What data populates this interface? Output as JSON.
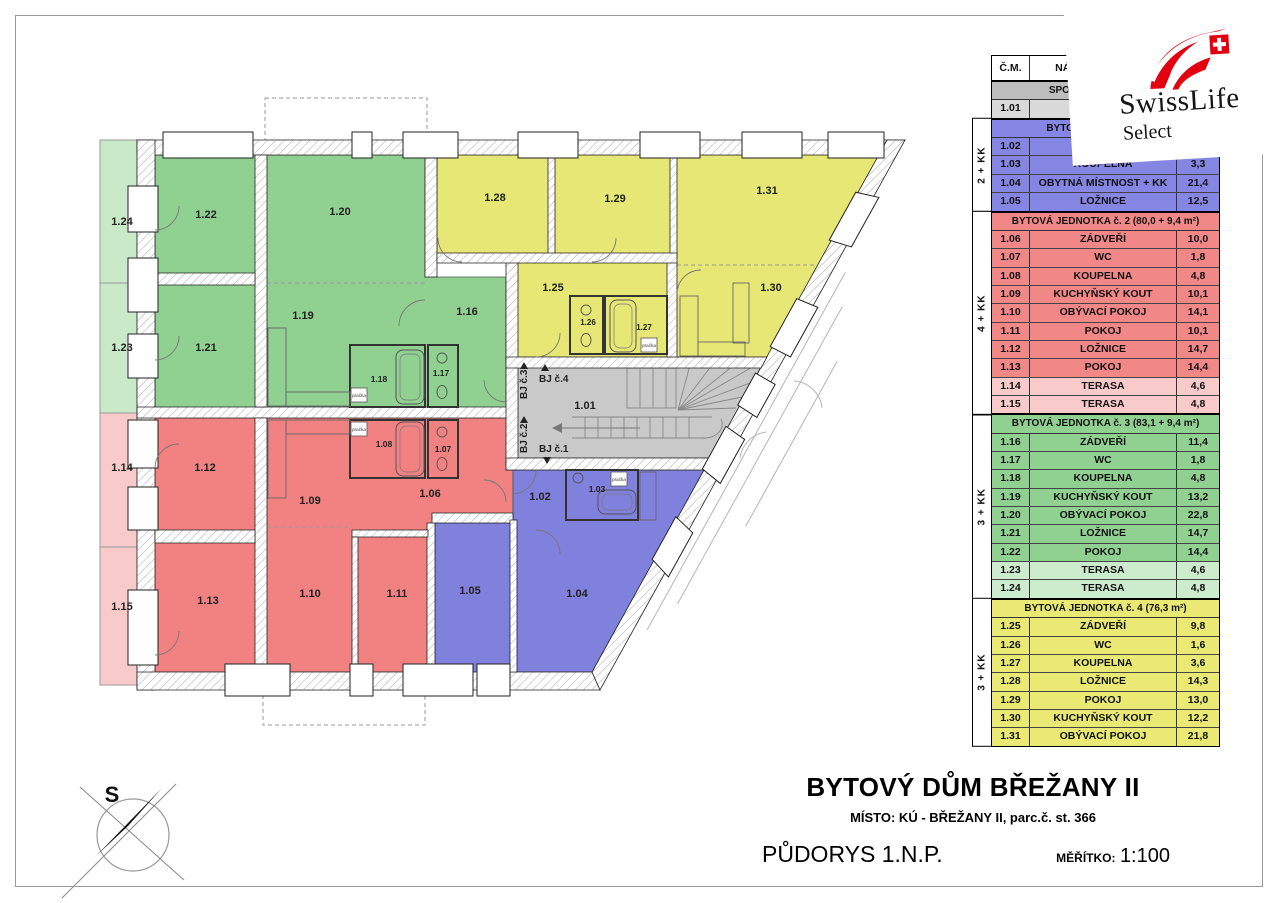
{
  "legend": {
    "columns": {
      "cm": "Č.M.",
      "name": "NÁZEV MÍSTNOSTI",
      "area": ""
    },
    "sections": [
      {
        "id": "common",
        "title": "SPOLEČNÉ PROSTORY",
        "side": "",
        "title_bg": "#bdbdbd",
        "row_bg": "#d9d9d9",
        "light_bg": "#d9d9d9",
        "rows": [
          {
            "cm": "1.01",
            "name": "CHODBA",
            "area": "",
            "light": false
          }
        ]
      },
      {
        "id": "unit-1",
        "title": "BYTOVÁ JEDNOTKA č. 1",
        "side": "2 + KK",
        "title_bg": "#8585e3",
        "row_bg": "#8585e3",
        "light_bg": "#8585e3",
        "rows": [
          {
            "cm": "1.02",
            "name": "ZÁDVEŘÍ",
            "area": "",
            "light": false
          },
          {
            "cm": "1.03",
            "name": "KOUPELNA",
            "area": "3,3",
            "light": false
          },
          {
            "cm": "1.04",
            "name": "OBYTNÁ MÍSTNOST + KK",
            "area": "21,4",
            "light": false
          },
          {
            "cm": "1.05",
            "name": "LOŽNICE",
            "area": "12,5",
            "light": false
          }
        ]
      },
      {
        "id": "unit-2",
        "title": "BYTOVÁ JEDNOTKA č. 2 (80,0 + 9,4 m²)",
        "side": "4 + KK",
        "title_bg": "#f28787",
        "row_bg": "#f28787",
        "light_bg": "#f8caca",
        "rows": [
          {
            "cm": "1.06",
            "name": "ZÁDVEŘÍ",
            "area": "10,0",
            "light": false
          },
          {
            "cm": "1.07",
            "name": "WC",
            "area": "1,8",
            "light": false
          },
          {
            "cm": "1.08",
            "name": "KOUPELNA",
            "area": "4,8",
            "light": false
          },
          {
            "cm": "1.09",
            "name": "KUCHYŇSKÝ KOUT",
            "area": "10,1",
            "light": false
          },
          {
            "cm": "1.10",
            "name": "OBÝVACÍ POKOJ",
            "area": "14,1",
            "light": false
          },
          {
            "cm": "1.11",
            "name": "POKOJ",
            "area": "10,1",
            "light": false
          },
          {
            "cm": "1.12",
            "name": "LOŽNICE",
            "area": "14,7",
            "light": false
          },
          {
            "cm": "1.13",
            "name": "POKOJ",
            "area": "14,4",
            "light": false
          },
          {
            "cm": "1.14",
            "name": "TERASA",
            "area": "4,6",
            "light": true
          },
          {
            "cm": "1.15",
            "name": "TERASA",
            "area": "4,8",
            "light": true
          }
        ]
      },
      {
        "id": "unit-3",
        "title": "BYTOVÁ JEDNOTKA č. 3 (83,1 + 9,4 m²)",
        "side": "3 + KK",
        "title_bg": "#90d191",
        "row_bg": "#90d191",
        "light_bg": "#cdeccd",
        "rows": [
          {
            "cm": "1.16",
            "name": "ZÁDVEŘÍ",
            "area": "11,4",
            "light": false
          },
          {
            "cm": "1.17",
            "name": "WC",
            "area": "1,8",
            "light": false
          },
          {
            "cm": "1.18",
            "name": "KOUPELNA",
            "area": "4,8",
            "light": false
          },
          {
            "cm": "1.19",
            "name": "KUCHYŇSKÝ KOUT",
            "area": "13,2",
            "light": false
          },
          {
            "cm": "1.20",
            "name": "OBÝVACÍ POKOJ",
            "area": "22,8",
            "light": false
          },
          {
            "cm": "1.21",
            "name": "LOŽNICE",
            "area": "14,7",
            "light": false
          },
          {
            "cm": "1.22",
            "name": "POKOJ",
            "area": "14,4",
            "light": false
          },
          {
            "cm": "1.23",
            "name": "TERASA",
            "area": "4,6",
            "light": true
          },
          {
            "cm": "1.24",
            "name": "TERASA",
            "area": "4,8",
            "light": true
          }
        ]
      },
      {
        "id": "unit-4",
        "title": "BYTOVÁ JEDNOTKA č. 4 (76,3 m²)",
        "side": "3 + KK",
        "title_bg": "#e9e973",
        "row_bg": "#e9e973",
        "light_bg": "#e9e973",
        "rows": [
          {
            "cm": "1.25",
            "name": "ZÁDVEŘÍ",
            "area": "9,8",
            "light": false
          },
          {
            "cm": "1.26",
            "name": "WC",
            "area": "1,6",
            "light": false
          },
          {
            "cm": "1.27",
            "name": "KOUPELNA",
            "area": "3,6",
            "light": false
          },
          {
            "cm": "1.28",
            "name": "LOŽNICE",
            "area": "14,3",
            "light": false
          },
          {
            "cm": "1.29",
            "name": "POKOJ",
            "area": "13,0",
            "light": false
          },
          {
            "cm": "1.30",
            "name": "KUCHYŇSKÝ KOUT",
            "area": "12,2",
            "light": false
          },
          {
            "cm": "1.31",
            "name": "OBÝVACÍ POKOJ",
            "area": "21,8",
            "light": false
          }
        ]
      }
    ]
  },
  "plan": {
    "room_labels": [
      "1.01",
      "1.02",
      "1.03",
      "1.04",
      "1.05",
      "1.06",
      "1.07",
      "1.08",
      "1.09",
      "1.10",
      "1.11",
      "1.12",
      "1.13",
      "1.14",
      "1.15",
      "1.16",
      "1.17",
      "1.18",
      "1.19",
      "1.20",
      "1.21",
      "1.22",
      "1.23",
      "1.24",
      "1.25",
      "1.26",
      "1.27",
      "1.28",
      "1.29",
      "1.30",
      "1.31"
    ],
    "entrances": [
      {
        "label": "BJ č.1",
        "dir": "down"
      },
      {
        "label": "BJ č.2",
        "dir": "up"
      },
      {
        "label": "BJ č.3",
        "dir": "up"
      },
      {
        "label": "BJ č.4",
        "dir": "up"
      }
    ],
    "washer_label": "pračka",
    "colors": {
      "unit1": "#8080dd",
      "unit2": "#f28282",
      "unit3": "#90d091",
      "unit4": "#e7e775",
      "common": "#c9c9c9",
      "terrace_green": "#c9e9c9",
      "terrace_red": "#f8caca"
    }
  },
  "logo": {
    "brand": "SwissLife",
    "product": "Select",
    "flag_color": "#e3000f"
  },
  "titleblock": {
    "project": "BYTOVÝ DŮM BŘEŽANY II",
    "location": "MÍSTO: KÚ - BŘEŽANY II, parc.č. st. 366",
    "drawing": "PŮDORYS 1.N.P.",
    "scale_label": "MĚŘÍTKO:",
    "scale_value": "1:100",
    "compass_letter": "S"
  }
}
